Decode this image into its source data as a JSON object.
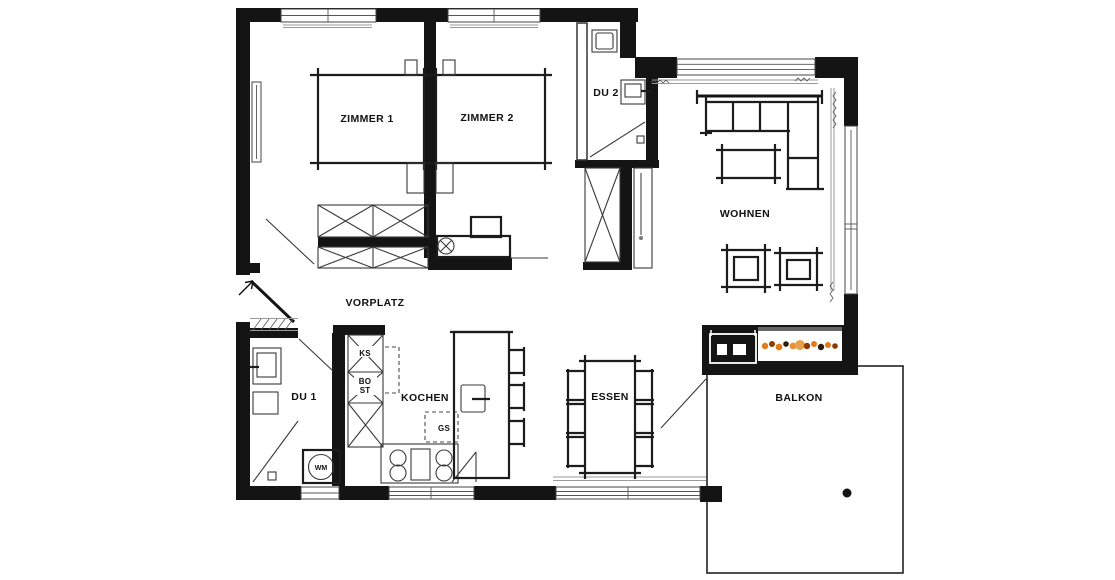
{
  "floorplan": {
    "rooms": {
      "zimmer1": "ZIMMER 1",
      "zimmer2": "ZIMMER 2",
      "du2": "DU 2",
      "wohnen": "WOHNEN",
      "vorplatz": "VORPLATZ",
      "du1": "DU 1",
      "kochen": "KOCHEN",
      "essen": "ESSEN",
      "balkon": "BALKON"
    },
    "appliance_labels": {
      "fridge": "KS",
      "oven": "BO",
      "steamer": "ST",
      "dishwasher": "GS",
      "washing_machine": "WM"
    },
    "colors": {
      "wall": "#141414",
      "furniture_line": "#1c1c1c",
      "window_gray": "#9a9a9a",
      "fire_orange": "#e07b1a",
      "fire_dark": "#8a3c00",
      "background": "#ffffff"
    }
  }
}
